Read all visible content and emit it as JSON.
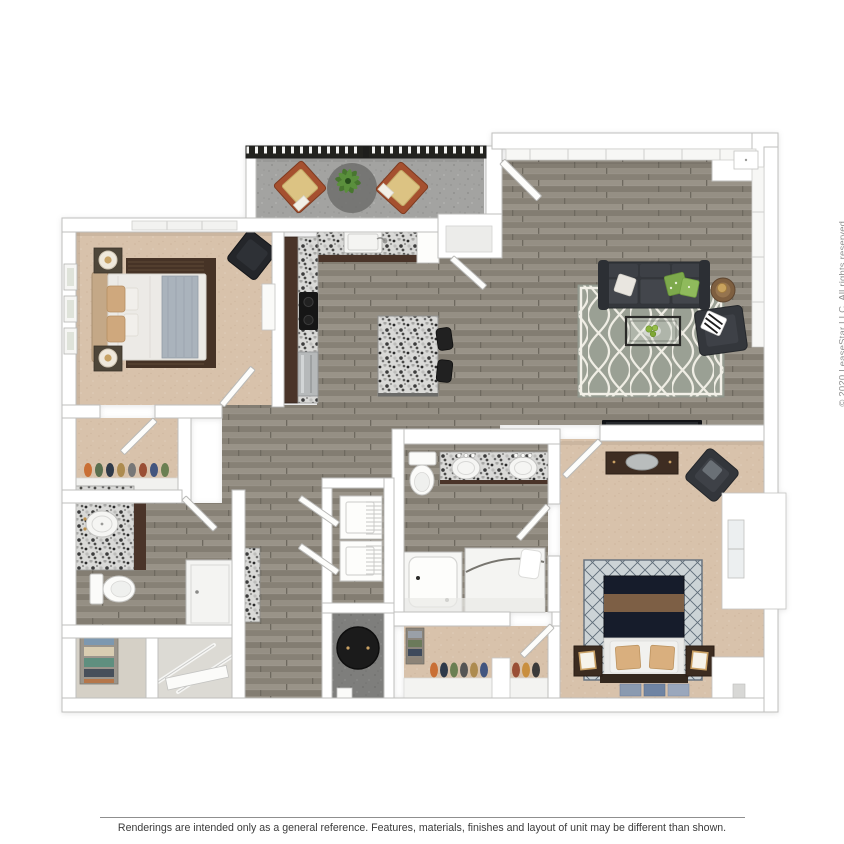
{
  "page": {
    "background_color": "#ffffff",
    "copyright_text": "© 2020 LeaseStar LLC. All rights reserved.",
    "disclaimer_text": "Renderings are intended only as a general reference. Features, materials, finishes and layout of unit may be different than shown."
  },
  "floor_plan": {
    "type": "3d_rendered_apartment_floor_plan",
    "view": "top-down",
    "rooms": [
      {
        "name": "balcony",
        "floor": "concrete",
        "furniture": [
          "lounge-chair",
          "lounge-chair",
          "potted-plant",
          "round-rug"
        ]
      },
      {
        "name": "living-room",
        "floor": "wood",
        "furniture": [
          "sofa",
          "quatrefoil-rug",
          "coffee-table",
          "accent-chair",
          "side-table",
          "tv"
        ]
      },
      {
        "name": "kitchen",
        "floor": "wood",
        "furniture": [
          "sink",
          "granite-counter",
          "cooktop",
          "dishwasher",
          "island",
          "bar-stool",
          "bar-stool"
        ]
      },
      {
        "name": "entry",
        "floor": "wood",
        "furniture": [
          "entry-closet",
          "front-door"
        ]
      },
      {
        "name": "bedroom-2",
        "floor": "carpet",
        "furniture": [
          "bed",
          "nightstand",
          "nightstand",
          "table-lamp",
          "table-lamp",
          "accent-chair",
          "wall-art"
        ]
      },
      {
        "name": "walk-in-closet-2",
        "floor": "carpet",
        "furniture": [
          "shoe-shelf"
        ]
      },
      {
        "name": "bathroom-2",
        "floor": "wood",
        "furniture": [
          "granite-vanity",
          "sink",
          "toilet",
          "shower"
        ]
      },
      {
        "name": "hall-closet",
        "floor": "vinyl",
        "furniture": [
          "linen-shelf"
        ]
      },
      {
        "name": "coat-closet",
        "floor": "vinyl",
        "furniture": [
          "closet-rods"
        ]
      },
      {
        "name": "laundry-closet",
        "floor": "wood",
        "furniture": [
          "washer",
          "dryer"
        ]
      },
      {
        "name": "utility-closet",
        "floor": "concrete",
        "furniture": [
          "water-heater"
        ]
      },
      {
        "name": "master-bathroom",
        "floor": "wood",
        "furniture": [
          "double-vanity",
          "toilet",
          "bathtub",
          "shower"
        ]
      },
      {
        "name": "master-closet",
        "floor": "carpet",
        "furniture": [
          "shoe-rack",
          "shelf-stack"
        ]
      },
      {
        "name": "master-bedroom",
        "floor": "carpet",
        "furniture": [
          "bed",
          "nightstand",
          "nightstand",
          "dresser",
          "oval-mirror",
          "accent-chair",
          "diamond-rug",
          "runner-rugs",
          "window-seat"
        ]
      }
    ],
    "colors": {
      "wood_floor": "#8f8a7f",
      "carpet": "#d8c2ab",
      "balcony_concrete": "#a3a3a1",
      "granite": "#d9d9d7",
      "dark_cabinetry": "#4a3429",
      "wall": "#ffffff",
      "wall_outline": "#bfbfbd",
      "sofa_charcoal": "#34373c",
      "navy_bedding": "#161c2b",
      "living_rug": "#9aa094",
      "accent_green": "#7da94c",
      "railing": "#23231f"
    }
  }
}
